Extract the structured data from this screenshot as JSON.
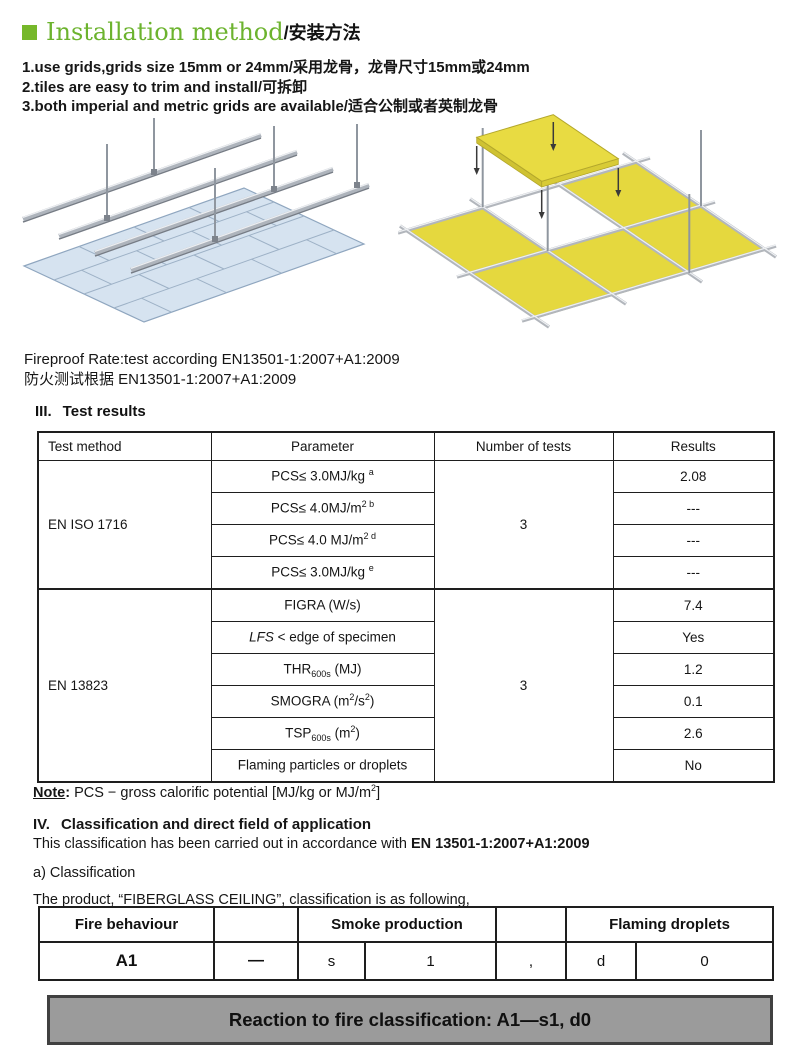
{
  "header": {
    "square_color": "#76b82a",
    "title_en": "Installation method",
    "title_zh": "/安装方法"
  },
  "intro": {
    "lines": [
      "1.use grids,grids size 15mm or 24mm/采用龙骨，龙骨尺寸15mm或24mm",
      "2.tiles are easy to trim and install/可拆卸",
      "3.both imperial and metric grids are available/适合公制或者英制龙骨"
    ]
  },
  "diagrams": {
    "left": "suspended-ceiling-grid-with-blue-tiles",
    "right": "t-grid-with-yellow-tiles-installation"
  },
  "fireproof": {
    "en": "Fireproof Rate:test according EN13501-1:2007+A1:2009",
    "zh": "防火测试根据 EN13501-1:2007+A1:2009"
  },
  "test_results": {
    "num": "III.",
    "heading": "Test results",
    "col_headers": [
      "Test method",
      "Parameter",
      "Number of tests",
      "Results"
    ],
    "group1": {
      "method": "EN ISO 1716",
      "tests": "3",
      "rows": [
        {
          "pre": "PCS≤ 3.0MJ/kg ",
          "sup": "a",
          "result": "2.08"
        },
        {
          "pre": "PCS≤ 4.0MJ/m",
          "sup": "2 b",
          "result": "---"
        },
        {
          "pre": "PCS≤ 4.0 MJ/m",
          "sup": "2 d",
          "result": "---"
        },
        {
          "pre": "PCS≤ 3.0MJ/kg ",
          "sup": "e",
          "result": "---"
        }
      ]
    },
    "group2": {
      "method": "EN 13823",
      "tests": "3",
      "rows": [
        {
          "pre": "FIGRA (W/s)",
          "result": "7.4"
        },
        {
          "italic": "LFS",
          "pre": " < edge of specimen",
          "result": "Yes"
        },
        {
          "pre": "THR",
          "sub": "600s",
          "mid": " (MJ)",
          "result": "1.2"
        },
        {
          "pre": "SMOGRA (m",
          "sup": "2",
          "mid2": "/s",
          "sup2": "2",
          "tail": ")",
          "result": "0.1"
        },
        {
          "pre": "TSP",
          "sub": "600s",
          "mid": " (m",
          "sup": "2",
          "tail": ")",
          "result": "2.6"
        },
        {
          "pre": "Flaming particles or droplets",
          "result": "No"
        }
      ]
    }
  },
  "note": {
    "label": "Note",
    "colon": ": ",
    "body": "PCS  −  gross calorific potential [MJ/kg or MJ/m",
    "sup": "2",
    "tail": "]"
  },
  "classification": {
    "num": "IV.",
    "heading": "Classification and direct field of application",
    "line1_normal": "This classification has been carried out in accordance with ",
    "line1_bold": "EN 13501-1:2007+A1:2009",
    "line2": "a) Classification",
    "line3": "The product, “FIBERGLASS CEILING”, classification is as following,",
    "table": {
      "h_fire": "Fire behaviour",
      "h_smoke": "Smoke production",
      "h_droplets": "Flaming droplets",
      "c_fire": "A1",
      "c_dash": "—",
      "c_s": "s",
      "c_s_val": "1",
      "c_comma": ",",
      "c_d": "d",
      "c_d_val": "0"
    }
  },
  "footer": {
    "text": "Reaction to fire classification: A1—s1, d0",
    "bg": "#9b9b9b"
  }
}
